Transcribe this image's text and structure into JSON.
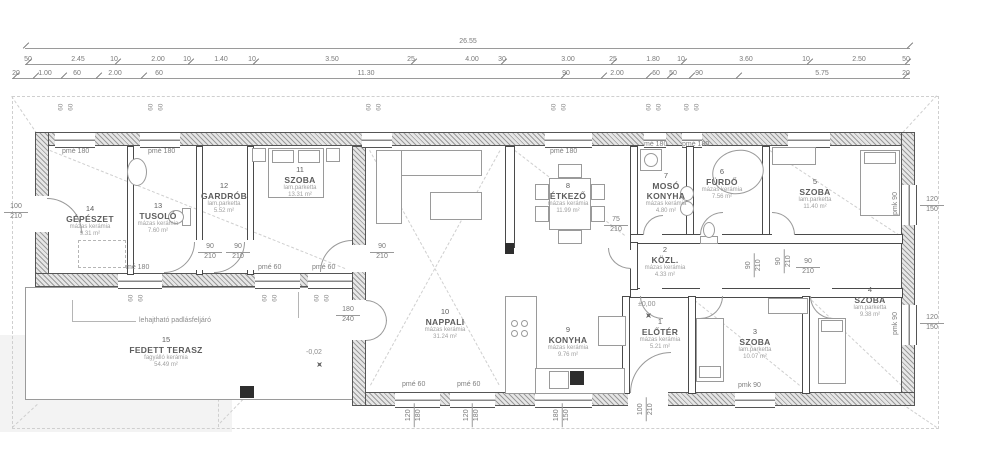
{
  "dims": {
    "total": "26.55",
    "row2": [
      "50",
      "2.45",
      "10",
      "2.00",
      "10",
      "1.40",
      "10",
      "3.50",
      "25",
      "4.00",
      "30",
      "3.00",
      "25",
      "1.80",
      "10",
      "3.60",
      "10",
      "2.50",
      "50"
    ],
    "row3": [
      "20",
      "1.00",
      "60",
      "2.00",
      "60",
      "11.30",
      "90",
      "2.00",
      "60",
      "50",
      "90",
      "5.75",
      "20"
    ]
  },
  "sizes": {
    "n60": "60",
    "n75": "75",
    "n90": "90",
    "n100": "100",
    "n120": "120",
    "n150": "150",
    "n180": "180",
    "n210": "210",
    "n240": "240"
  },
  "tags": {
    "pme180": "pmé 180",
    "me180": "mé 180",
    "pme60": "pmé 60",
    "pmk90": "pmk 90"
  },
  "annotations": {
    "attic": "lehajtható padlásfeljáró",
    "lvl_zero": "±0,00",
    "lvl_terrace": "-0,02"
  },
  "rooms": [
    {
      "num": "1",
      "name": "ELŐTÉR",
      "material": "mázas kerámia",
      "area": "5.21 m²"
    },
    {
      "num": "2",
      "name": "KÖZL.",
      "material": "mázas kerámia",
      "area": "4.33 m²"
    },
    {
      "num": "3",
      "name": "SZOBA",
      "material": "lam.parketta",
      "area": "10.07 m²"
    },
    {
      "num": "4",
      "name": "SZOBA",
      "material": "lam.parketta",
      "area": "9.38 m²"
    },
    {
      "num": "5",
      "name": "SZOBA",
      "material": "lam.parketta",
      "area": "11.40 m²"
    },
    {
      "num": "6",
      "name": "FÜRDŐ",
      "material": "mázas kerámia",
      "area": "7.56 m²"
    },
    {
      "num": "7",
      "name": "MOSÓ KONYHA",
      "material": "mázas kerámia",
      "area": "4.80 m²"
    },
    {
      "num": "8",
      "name": "ÉTKEZŐ",
      "material": "mázas kerámia",
      "area": "11.99 m²"
    },
    {
      "num": "9",
      "name": "KONYHA",
      "material": "mázas kerámia",
      "area": "9.76 m²"
    },
    {
      "num": "10",
      "name": "NAPPALI",
      "material": "mázas kerámia",
      "area": "31.24 m²"
    },
    {
      "num": "11",
      "name": "SZOBA",
      "material": "lam.parketta",
      "area": "13.31 m²"
    },
    {
      "num": "12",
      "name": "GARDRÓB",
      "material": "lam.parketta",
      "area": "5.52 m²"
    },
    {
      "num": "13",
      "name": "TUSOLÓ",
      "material": "mázas kerámia",
      "area": "7.60 m²"
    },
    {
      "num": "14",
      "name": "GÉPÉSZET",
      "material": "mázas kerámia",
      "area": "9.31 m²"
    },
    {
      "num": "15",
      "name": "FEDETT TERASZ",
      "material": "fagyálló kerámia",
      "area": "54.49 m²"
    }
  ]
}
